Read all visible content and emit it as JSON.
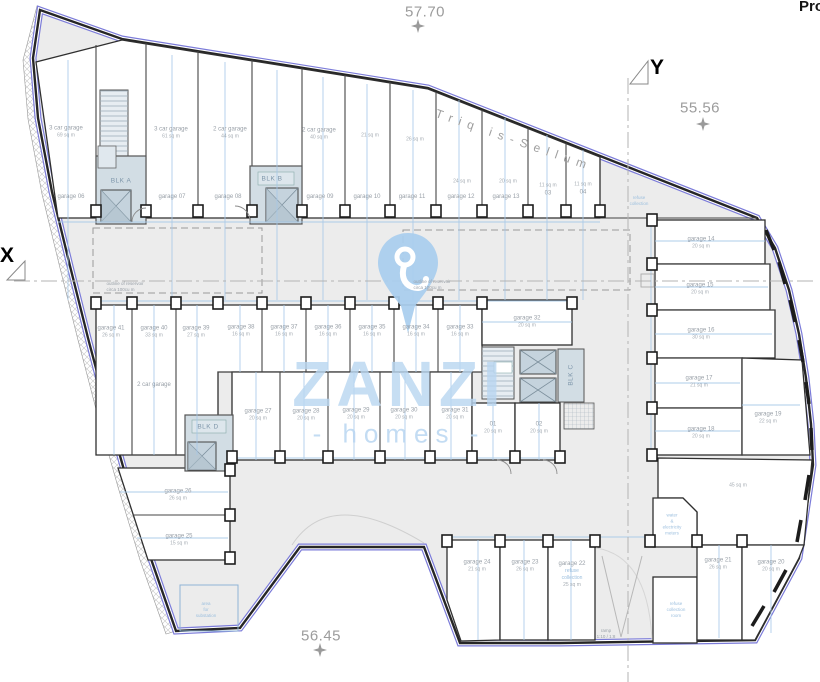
{
  "corner_text": "Pro",
  "levels": {
    "top": "57.70",
    "right": "55.56",
    "bottom": "56.45"
  },
  "street": "Triq is-Sellum",
  "axes": {
    "x": "X",
    "y": "Y"
  },
  "watermark": {
    "brand": "ZANZI",
    "tagline": "- homes -"
  },
  "blocks": {
    "a": "BLK A",
    "b": "BLK B",
    "c": "BLK C",
    "d": "BLK D"
  },
  "notes": {
    "reservoir_left": "outline of reservoir\ncirca 100cu m",
    "reservoir_right": "outline of reservoir\ncirca 100cu m",
    "refuse_collection_top": "refuse\ncollection",
    "substation": "area\nfor\nsubstation",
    "water_meters": "water\n&\nelectricity\nmeters",
    "refuse_room": "refuse\ncollection\nroom",
    "ramp": "ramp\n1:10 / 1:8",
    "open_area": "45 sq m"
  },
  "rooms": {
    "g06": {
      "name": "garage 06",
      "sub": "3 car garage",
      "area": "69 sq m"
    },
    "g07": {
      "name": "garage 07",
      "sub": "3 car garage",
      "area": "61 sq m"
    },
    "g08": {
      "name": "garage 08",
      "sub": "2 car garage",
      "area": "44 sq m"
    },
    "g09": {
      "name": "garage 09",
      "sub": "2 car garage",
      "area": "40 sq m"
    },
    "g10": {
      "name": "garage 10",
      "area": "21 sq m"
    },
    "g11": {
      "name": "garage 11",
      "area": "26 sq m"
    },
    "g12": {
      "name": "garage 12",
      "area": "24 sq m"
    },
    "g13": {
      "name": "garage 13",
      "area": "20 sq m"
    },
    "r03": {
      "name": "03",
      "area": "11 sq m"
    },
    "r04": {
      "name": "04",
      "area": "11 sq m"
    },
    "g14": {
      "name": "garage 14",
      "area": "20 sq m"
    },
    "g15": {
      "name": "garage 15",
      "area": "20 sq m"
    },
    "g16": {
      "name": "garage 16",
      "area": "30 sq m"
    },
    "g17": {
      "name": "garage 17",
      "area": "21 sq m"
    },
    "g18": {
      "name": "garage 18",
      "area": "20 sq m"
    },
    "g19": {
      "name": "garage 19",
      "area": "22 sq m"
    },
    "g20": {
      "name": "garage 20",
      "area": "20 sq m"
    },
    "g21": {
      "name": "garage 21",
      "area": "26 sq m"
    },
    "g22": {
      "name": "garage 22",
      "area": "25 sq m",
      "note": "refuse\ncollection"
    },
    "g23": {
      "name": "garage 23",
      "area": "26 sq m"
    },
    "g24": {
      "name": "garage 24",
      "area": "21 sq m"
    },
    "g25": {
      "name": "garage 25",
      "area": "15 sq m"
    },
    "g26": {
      "name": "garage 26",
      "area": "26 sq m"
    },
    "g27": {
      "name": "garage 27",
      "area": "20 sq m"
    },
    "g28": {
      "name": "garage 28",
      "area": "20 sq m"
    },
    "g29": {
      "name": "garage 29",
      "area": "20 sq m"
    },
    "g30": {
      "name": "garage 30",
      "area": "20 sq m"
    },
    "g31": {
      "name": "garage 31",
      "area": "20 sq m"
    },
    "g32": {
      "name": "garage 32",
      "area": "20 sq m"
    },
    "g33": {
      "name": "garage 33",
      "area": "16 sq m"
    },
    "g34": {
      "name": "garage 34",
      "area": "16 sq m"
    },
    "g35": {
      "name": "garage 35",
      "area": "16 sq m"
    },
    "g36": {
      "name": "garage 36",
      "area": "16 sq m"
    },
    "g37": {
      "name": "garage 37",
      "area": "16 sq m"
    },
    "g38": {
      "name": "garage 38",
      "area": "16 sq m"
    },
    "g39": {
      "name": "garage 39",
      "area": "27 sq m"
    },
    "g40": {
      "name": "garage 40",
      "area": "33 sq m",
      "sub": "2 car garage"
    },
    "g41": {
      "name": "garage 41",
      "area": "26 sq m"
    },
    "r01": {
      "name": "01",
      "area": "20 sq m"
    },
    "r02": {
      "name": "02",
      "area": "20 sq m"
    }
  }
}
